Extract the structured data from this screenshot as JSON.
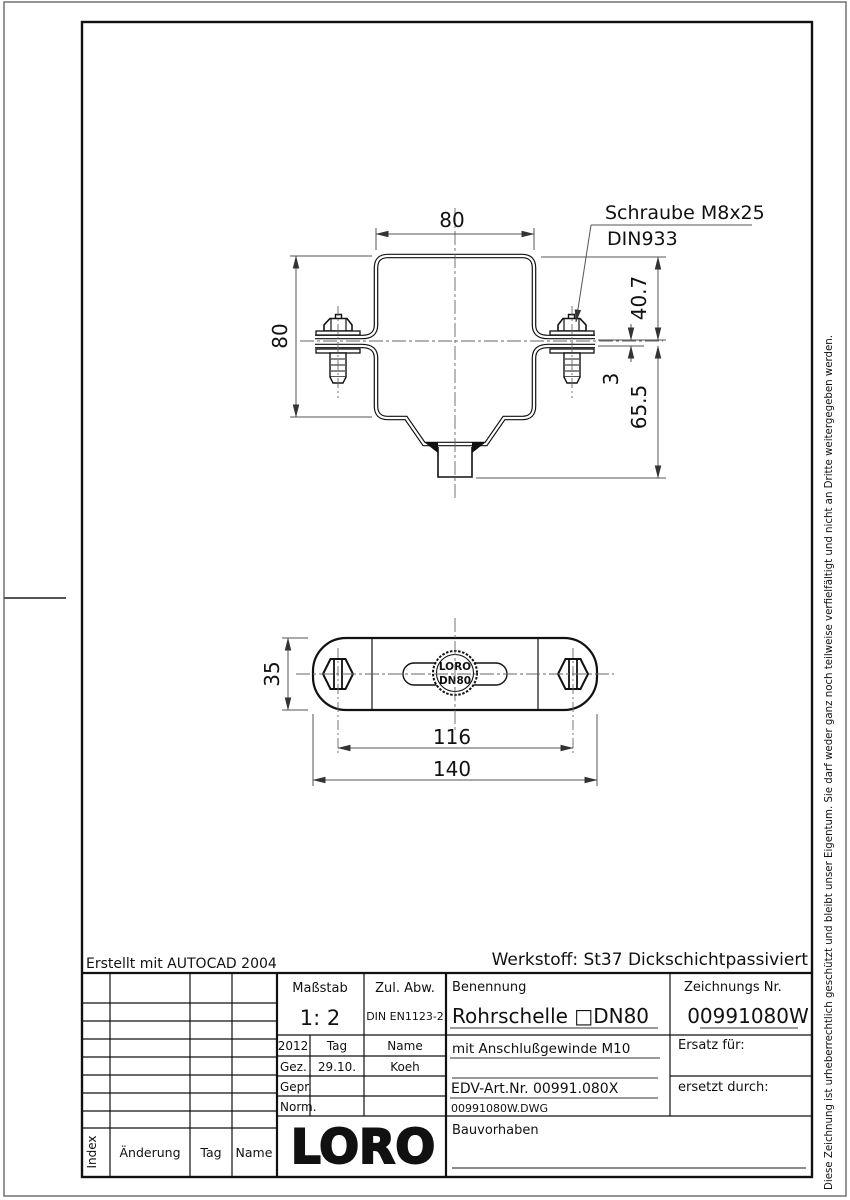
{
  "notes": {
    "created_with": "Erstellt mit AUTOCAD 2004",
    "material": "Werkstoff: St37 Dickschichtpassiviert",
    "copyright": "Diese Zeichnung ist urheberrechtlich geschützt und bleibt unser Eigentum. Sie darf weder ganz noch teilweise verfielfältigt und nicht an Dritte weitergegeben werden."
  },
  "front_view": {
    "leader_line1": "Schraube M8x25",
    "leader_line2": "DIN933",
    "dim_width_top": "80",
    "dim_height_left": "80",
    "dim_40_7": "40.7",
    "dim_3": "3",
    "dim_65_5": "65.5"
  },
  "plan_view": {
    "stamp_line1": "LORO",
    "stamp_line2": "DN80",
    "dim_height": "35",
    "dim_spacing": "116",
    "dim_overall": "140"
  },
  "title_block": {
    "scale_label": "Maßstab",
    "scale_value": "1: 2",
    "tol_label": "Zul. Abw.",
    "tol_value": "DIN EN1123-2",
    "year": "2012",
    "col_tag": "Tag",
    "col_name": "Name",
    "rows": [
      {
        "role": "Gez.",
        "date": "29.10.",
        "by": "Koeh"
      },
      {
        "role": "Gepr.",
        "date": "",
        "by": ""
      },
      {
        "role": "Norm.",
        "date": "",
        "by": ""
      }
    ],
    "benennung_label": "Benennung",
    "benennung_value": "Rohrschelle □DN80",
    "subtitle": "mit Anschlußgewinde M10",
    "edv": "EDV-Art.Nr. 00991.080X",
    "file": "00991080W.DWG",
    "zeichnung_label": "Zeichnungs Nr.",
    "zeichnung_value": "00991080W",
    "ersatz": "Ersatz für:",
    "ersetzt": "ersetzt durch:",
    "bauvorhaben": "Bauvorhaben",
    "logo": "LORO",
    "rev_index": "Index",
    "rev_change": "Änderung",
    "rev_tag": "Tag",
    "rev_name": "Name"
  }
}
